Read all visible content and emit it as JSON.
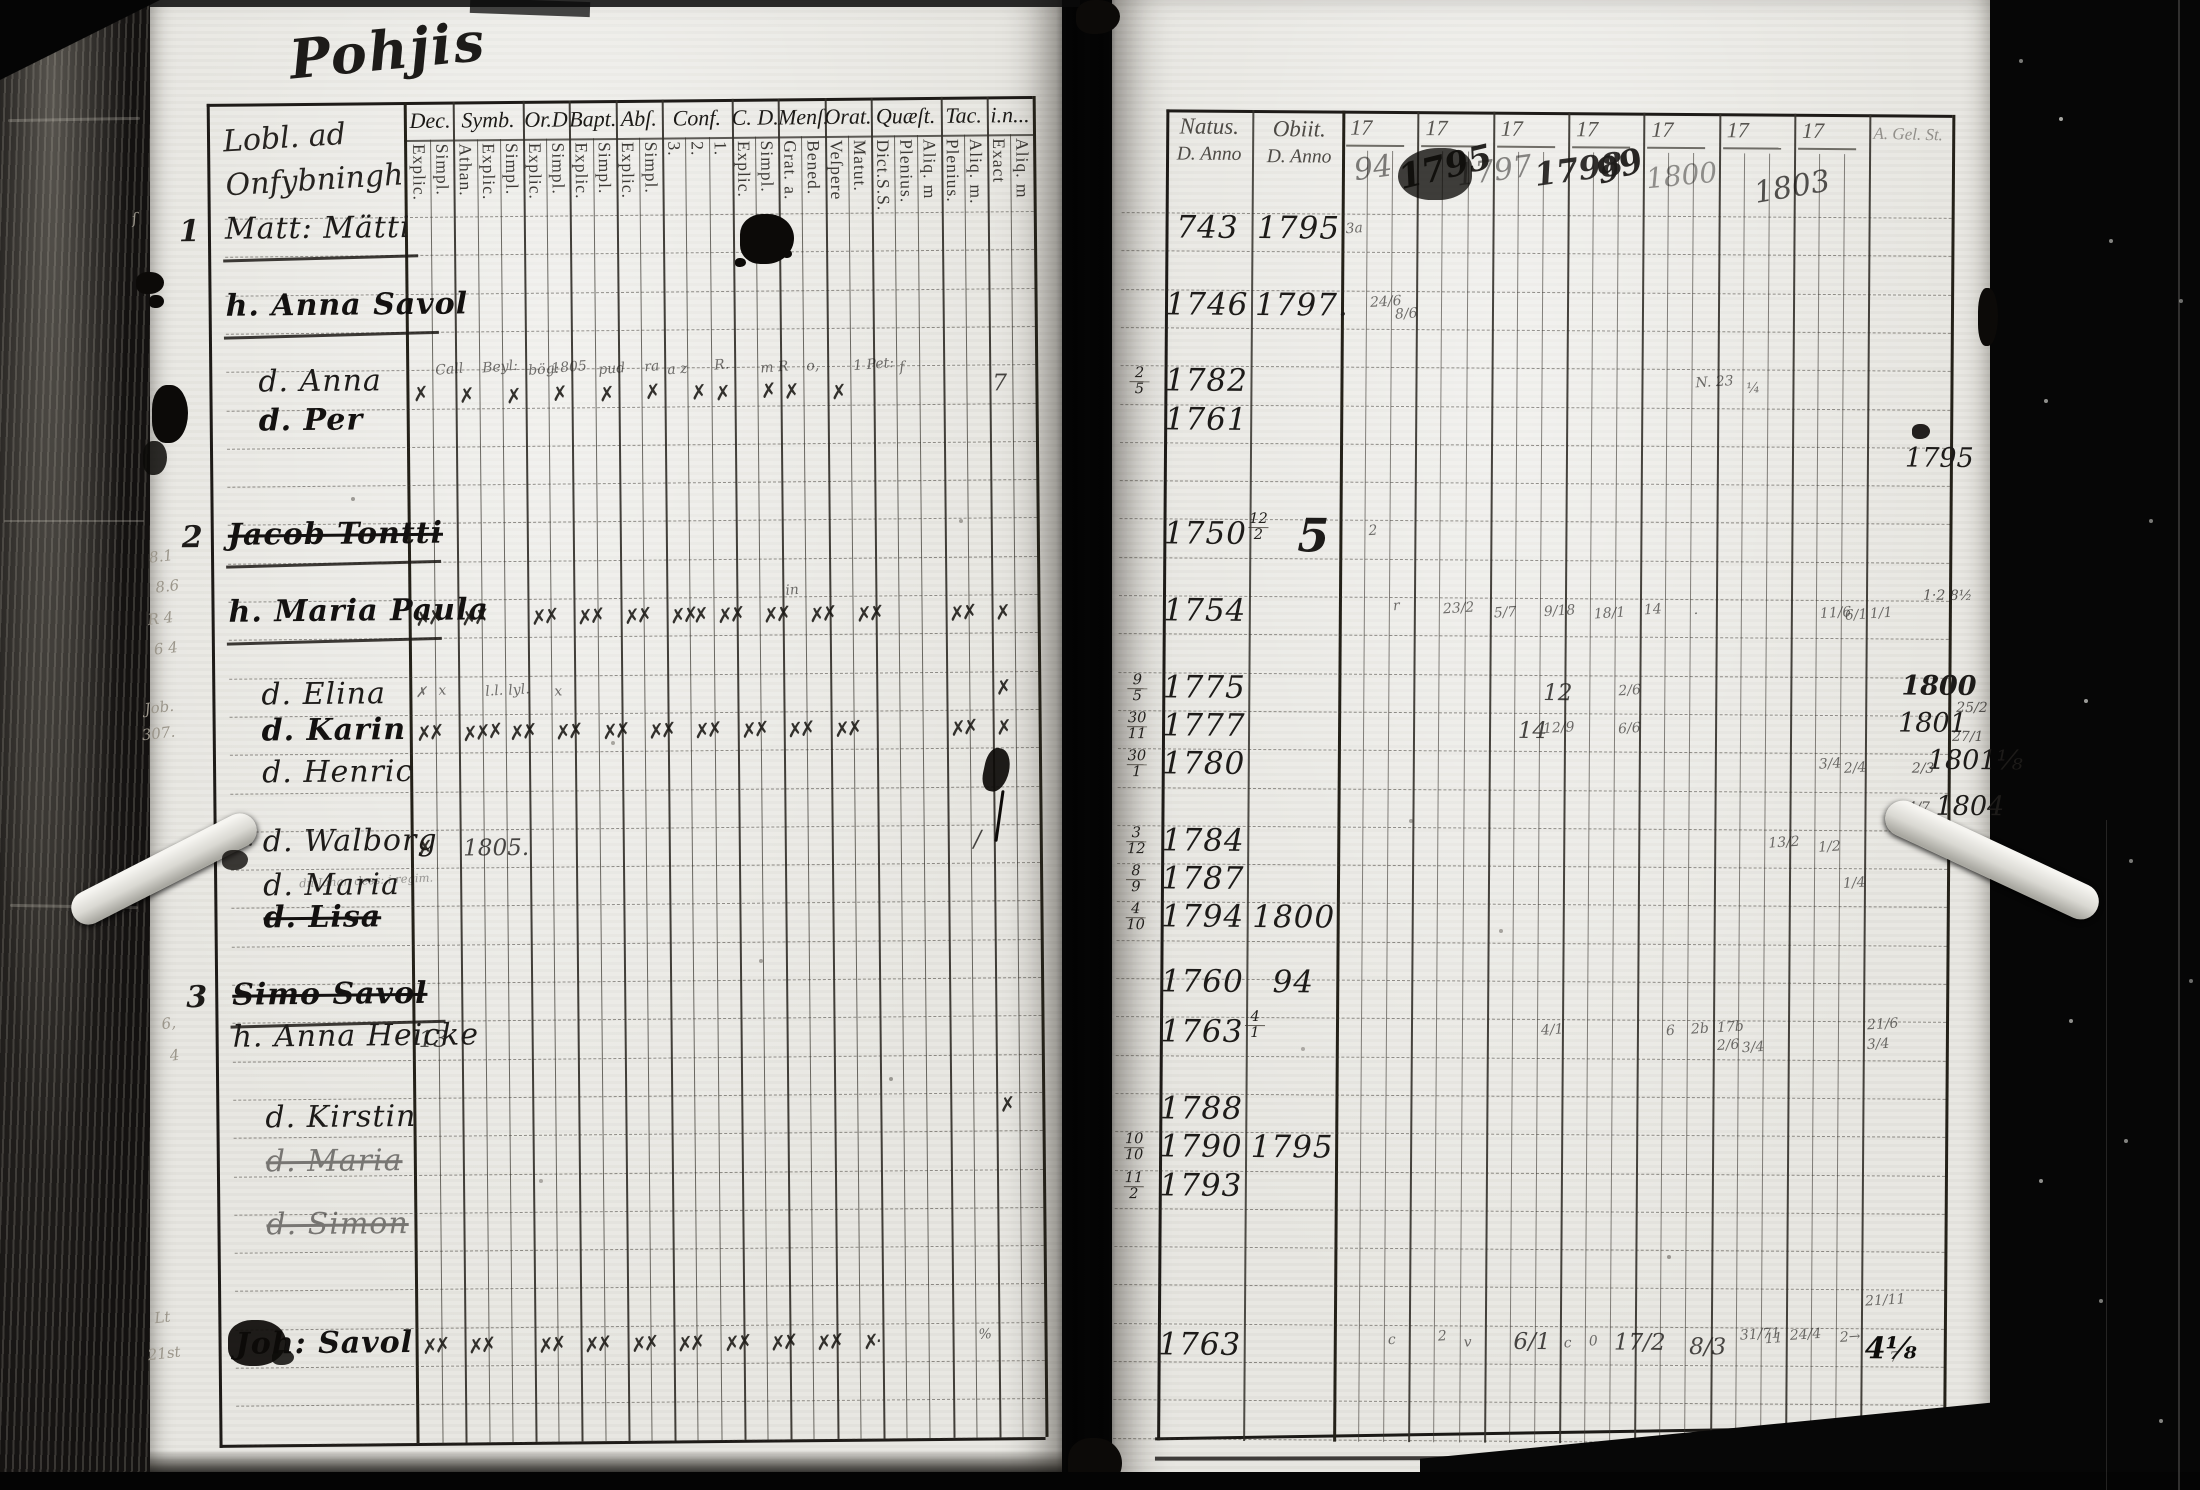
{
  "title": "Pohjis",
  "left_page": {
    "heading_line1": "Lobl. ad",
    "heading_line2": "Onfybningh",
    "columns": [
      {
        "label": "Dec.",
        "subs": [
          "Explic.",
          "Simpl."
        ]
      },
      {
        "label": "Symb.",
        "subs": [
          "Athan.",
          "Explic.",
          "Simpl."
        ]
      },
      {
        "label": "Or.D",
        "subs": [
          "Explic.",
          "Simpl."
        ]
      },
      {
        "label": "Bapt.",
        "subs": [
          "Explic.",
          "Simpl."
        ]
      },
      {
        "label": "Abſ.",
        "subs": [
          "Explic.",
          "Simpl."
        ]
      },
      {
        "label": "Conf.",
        "subs": [
          "3.",
          "2.",
          "1."
        ]
      },
      {
        "label": "C. D.",
        "subs": [
          "Explic.",
          "Simpl."
        ]
      },
      {
        "label": "Menſ.",
        "subs": [
          "Grat. a.",
          "Bened."
        ]
      },
      {
        "label": "Orat.",
        "subs": [
          "Veſpere",
          "Matut."
        ]
      },
      {
        "label": "Quæſt.",
        "subs": [
          "Dict.S.S.",
          "Plenius.",
          "Aliq. m"
        ]
      },
      {
        "label": "Tac.",
        "subs": [
          "Plenius.",
          "Aliq. m."
        ]
      },
      {
        "label": "i.n...",
        "subs": [
          "Exact",
          "Aliq. m"
        ]
      }
    ],
    "row_numbers": [
      {
        "n": "1",
        "r": 0
      },
      {
        "n": "2",
        "r": 8
      },
      {
        "n": "3",
        "r": 20
      }
    ],
    "entries": [
      {
        "r": 0,
        "name": "Matt: Mätti",
        "u": 1
      },
      {
        "r": 2,
        "name": "h. Anna Savol",
        "u": 1,
        "b": 1
      },
      {
        "r": 4,
        "name": "d. Anna",
        "ind": 1
      },
      {
        "r": 5,
        "name": "d. Per",
        "ind": 1,
        "b": 1
      },
      {
        "r": 8,
        "name": "Jacob Tontti",
        "u": 1,
        "b": 1,
        "s": 1
      },
      {
        "r": 10,
        "name": "h. Maria Paula",
        "u": 1,
        "b": 1
      },
      {
        "r": 12,
        "name": "d. Elina",
        "ind": 1,
        "dy": 6
      },
      {
        "r": 13,
        "name": "d. Karin",
        "ind": 1,
        "dy": 4,
        "b": 1
      },
      {
        "r": 14,
        "name": "d. Henric",
        "ind": 1,
        "dy": 8
      },
      {
        "r": 16,
        "name": "d. Walborg",
        "ind": 1,
        "pre": "Jf.",
        "note": "dn Johan dess: i regim."
      },
      {
        "r": 17,
        "name": "d. Maria",
        "ind": 1,
        "dy": 6
      },
      {
        "r": 18,
        "name": "d. Lisa",
        "ind": 1,
        "b": 1,
        "s": 1
      },
      {
        "r": 20,
        "name": "Simo Savol",
        "u": 1,
        "b": 1,
        "s": 1
      },
      {
        "r": 21,
        "name": "h. Anna Heicke",
        "dy": 4
      },
      {
        "r": 23,
        "name": "d. Kirstin",
        "ind": 1,
        "dy": 8
      },
      {
        "r": 24,
        "name": "d. Maria",
        "ind": 1,
        "s": 1,
        "dy": 14,
        "f": 1
      },
      {
        "r": 26,
        "name": "d. Simon",
        "ind": 1,
        "s": 1,
        "f": 1
      },
      {
        "r": 29,
        "name": "Joh: Savol",
        "b": 1,
        "dy": 4
      }
    ],
    "marks": [
      [
        4,
        1,
        "Call",
        "w",
        -14
      ],
      [
        4,
        3,
        "Beyl:",
        "w",
        -16
      ],
      [
        4,
        5,
        "bög:",
        "w",
        -13
      ],
      [
        4,
        6,
        "1805",
        "w",
        -15
      ],
      [
        4,
        8,
        "pud",
        "w",
        -13
      ],
      [
        4,
        10,
        "ra",
        "w",
        -15
      ],
      [
        4,
        11,
        "a z",
        "w",
        -12
      ],
      [
        4,
        13,
        "R.",
        "w",
        -16
      ],
      [
        4,
        15,
        "m R",
        "w",
        -13
      ],
      [
        4,
        17,
        "o,",
        "w",
        -14
      ],
      [
        4,
        19,
        "1 Pet:",
        "w",
        -15
      ],
      [
        4,
        21,
        "f",
        "w",
        -12
      ],
      [
        4,
        0,
        "✗",
        "x",
        6
      ],
      [
        4,
        2,
        "✗",
        "x",
        8
      ],
      [
        4,
        4,
        "✗",
        "x",
        9
      ],
      [
        4,
        6,
        "✗",
        "x",
        7
      ],
      [
        4,
        8,
        "✗",
        "x",
        8
      ],
      [
        4,
        10,
        "✗",
        "x",
        6
      ],
      [
        4,
        12,
        "✗",
        "x",
        7
      ],
      [
        4,
        13,
        "✗",
        "x",
        8
      ],
      [
        4,
        15,
        "✗",
        "x",
        6
      ],
      [
        4,
        16,
        "✗",
        "x",
        7
      ],
      [
        4,
        18,
        "✗",
        "x",
        8
      ],
      [
        4,
        25,
        "7",
        "h",
        0
      ],
      [
        10,
        0,
        "✗✗",
        "x",
        0
      ],
      [
        10,
        2,
        "✗✗",
        "x",
        0
      ],
      [
        10,
        5,
        "✗✗",
        "x",
        0
      ],
      [
        10,
        7,
        "✗✗",
        "x",
        0
      ],
      [
        10,
        9,
        "✗✗",
        "x",
        0
      ],
      [
        10,
        11,
        "✗✗",
        "x",
        0
      ],
      [
        10,
        12,
        "✗",
        "x",
        0
      ],
      [
        10,
        13,
        "✗✗",
        "x",
        0
      ],
      [
        10,
        15,
        "✗✗",
        "x",
        0
      ],
      [
        10,
        17,
        "✗✗",
        "x",
        0
      ],
      [
        10,
        19,
        "✗✗",
        "x",
        0
      ],
      [
        10,
        23,
        "✗✗",
        "x",
        0
      ],
      [
        10,
        25,
        "✗",
        "x",
        0
      ],
      [
        10,
        16,
        "in",
        "w",
        -20
      ],
      [
        12,
        0,
        "✗",
        "w",
        2
      ],
      [
        12,
        1,
        "x",
        "w",
        0
      ],
      [
        12,
        3,
        "l.l.",
        "w",
        1
      ],
      [
        12,
        4,
        "lyl.",
        "w",
        0
      ],
      [
        12,
        6,
        "x",
        "w",
        2
      ],
      [
        12,
        25,
        "✗",
        "x",
        -2
      ],
      [
        13,
        0,
        "✗✗",
        "x",
        0
      ],
      [
        13,
        2,
        "✗✗✗",
        "x",
        0
      ],
      [
        13,
        4,
        "✗✗",
        "x",
        0
      ],
      [
        13,
        6,
        "✗✗",
        "x",
        0
      ],
      [
        13,
        8,
        "✗✗",
        "x",
        0
      ],
      [
        13,
        10,
        "✗✗",
        "x",
        0
      ],
      [
        13,
        12,
        "✗✗",
        "x",
        0
      ],
      [
        13,
        14,
        "✗✗",
        "x",
        0
      ],
      [
        13,
        16,
        "✗✗",
        "x",
        0
      ],
      [
        13,
        18,
        "✗✗",
        "x",
        0
      ],
      [
        13,
        23,
        "✗✗",
        "x",
        0
      ],
      [
        13,
        25,
        "✗",
        "x",
        0
      ],
      [
        16,
        0,
        "✗",
        "x",
        0
      ],
      [
        16,
        2,
        "1805.",
        "h",
        0
      ],
      [
        16,
        24,
        "∕",
        "h",
        -4
      ],
      [
        21,
        0,
        "13",
        "h",
        0
      ],
      [
        23,
        25,
        "✗",
        "x",
        -6
      ],
      [
        29,
        0,
        "✗✗",
        "x",
        0
      ],
      [
        29,
        2,
        "✗✗",
        "x",
        0
      ],
      [
        29,
        5,
        "✗✗",
        "x",
        0
      ],
      [
        29,
        7,
        "✗✗",
        "x",
        0
      ],
      [
        29,
        9,
        "✗✗",
        "x",
        0
      ],
      [
        29,
        11,
        "✗✗",
        "x",
        0
      ],
      [
        29,
        13,
        "✗✗",
        "x",
        0
      ],
      [
        29,
        15,
        "✗✗",
        "x",
        0
      ],
      [
        29,
        17,
        "✗✗",
        "x",
        0
      ],
      [
        29,
        19,
        "✗·",
        "x",
        0
      ],
      [
        29,
        24,
        "%",
        "w",
        -2
      ]
    ],
    "margin_notes": [
      {
        "t": "ſ",
        "x": 137,
        "y": 205
      },
      {
        "t": "8.1",
        "x": 151,
        "y": 543
      },
      {
        "t": "8.6",
        "x": 157,
        "y": 573
      },
      {
        "t": "R 4",
        "x": 149,
        "y": 605
      },
      {
        "t": "6 4",
        "x": 155,
        "y": 635
      },
      {
        "t": "Job.",
        "x": 145,
        "y": 694
      },
      {
        "t": "307.",
        "x": 142,
        "y": 720
      },
      {
        "t": "6,",
        "x": 159,
        "y": 1010
      },
      {
        "t": "4",
        "x": 167,
        "y": 1042
      },
      {
        "t": "Lt",
        "x": 149,
        "y": 1304
      },
      {
        "t": "21st",
        "x": 142,
        "y": 1340
      }
    ]
  },
  "right_page": {
    "natus_label": "Natus.",
    "natus_sub": "D. Anno",
    "obiit_label": "Obiit.",
    "obiit_sub": "D. Anno",
    "year_prefix": "17",
    "written_years": [
      "94",
      "1795",
      "1797",
      "1798",
      "99",
      "1800",
      "1803"
    ],
    "end_label": "A. Gel. St.",
    "entries": [
      {
        "r": 0,
        "natus": "743",
        "obiit": "1795"
      },
      {
        "r": 2,
        "natus": "1746",
        "obiit": "1797."
      },
      {
        "r": 4,
        "day": "2|5",
        "natus": "1782"
      },
      {
        "r": 5,
        "natus": "1761"
      },
      {
        "r": 8,
        "natus": "1750",
        "obiit": "5",
        "big": 1,
        "osmall": "12|2"
      },
      {
        "r": 10,
        "natus": "1754"
      },
      {
        "r": 12,
        "day": "9|5",
        "natus": "1775"
      },
      {
        "r": 13,
        "day": "30|11",
        "natus": "1777"
      },
      {
        "r": 14,
        "day": "30|1",
        "natus": "1780"
      },
      {
        "r": 16,
        "day": "3|12",
        "natus": "1784"
      },
      {
        "r": 17,
        "day": "8|9",
        "natus": "1787"
      },
      {
        "r": 18,
        "day": "4|10",
        "natus": "1794",
        "obiit": "1800"
      },
      {
        "r": 20,
        "natus": "1760",
        "obiit": "94",
        "dy": -12
      },
      {
        "r": 21,
        "natus": "1763",
        "osmall": "4|1"
      },
      {
        "r": 23,
        "natus": "1788"
      },
      {
        "r": 24,
        "day": "10|10",
        "natus": "1790",
        "obiit": "1795"
      },
      {
        "r": 25,
        "day": "11|2",
        "natus": "1793"
      },
      {
        "r": 29,
        "natus": "1763",
        "dy": 6
      }
    ],
    "marks": [
      [
        0,
        0,
        "3a",
        "w",
        0
      ],
      [
        2,
        1,
        "24/6",
        "w",
        -4
      ],
      [
        2,
        2,
        "8/6",
        "w",
        8
      ],
      [
        4,
        14,
        "N. 23",
        "w",
        -2
      ],
      [
        4,
        16,
        "¼",
        "w",
        4
      ],
      [
        8,
        1,
        "2",
        "w",
        -4
      ],
      [
        10,
        2,
        "r",
        "w",
        -6
      ],
      [
        10,
        4,
        "23/2",
        "w",
        -4
      ],
      [
        10,
        6,
        "5/7",
        "w",
        0
      ],
      [
        10,
        8,
        "9/18",
        "w",
        -2
      ],
      [
        10,
        10,
        "18/1",
        "w",
        0
      ],
      [
        10,
        12,
        "14",
        "w",
        -4
      ],
      [
        10,
        14,
        "·",
        "w",
        0
      ],
      [
        10,
        19,
        "11/6",
        "w",
        -2
      ],
      [
        10,
        20,
        "6/1",
        "w",
        0
      ],
      [
        10,
        21,
        "1/1",
        "w",
        -2
      ],
      [
        12,
        8,
        "12",
        "h",
        -2
      ],
      [
        12,
        11,
        "2/6",
        "w",
        0
      ],
      [
        13,
        7,
        "14",
        "h",
        -2
      ],
      [
        13,
        8,
        "12/9",
        "w",
        0
      ],
      [
        13,
        11,
        "6/6",
        "w",
        0
      ],
      [
        14,
        19,
        "3/4",
        "w",
        -4
      ],
      [
        14,
        20,
        "2/4",
        "w",
        0
      ],
      [
        16,
        17,
        "13/2",
        "w",
        -2
      ],
      [
        16,
        19,
        "1/2",
        "w",
        2
      ],
      [
        17,
        20,
        "1/4",
        "w",
        0
      ],
      [
        21,
        8,
        "4/1",
        "w",
        -4
      ],
      [
        21,
        13,
        "6",
        "w",
        -4
      ],
      [
        21,
        14,
        "2b",
        "w",
        -6
      ],
      [
        21,
        15,
        "17b",
        "w",
        -8
      ],
      [
        21,
        15,
        "2/6",
        "w",
        10
      ],
      [
        21,
        16,
        "3/4",
        "w",
        12
      ],
      [
        21,
        21,
        "21/6",
        "w",
        -12
      ],
      [
        21,
        21,
        "3/4",
        "w",
        8
      ],
      [
        28,
        21,
        "21/11",
        "w",
        -4
      ],
      [
        29,
        2,
        "c",
        "w",
        0
      ],
      [
        29,
        4,
        "2",
        "w",
        -4
      ],
      [
        29,
        5,
        "v",
        "w",
        2
      ],
      [
        29,
        7,
        "6/1",
        "h",
        -4
      ],
      [
        29,
        9,
        "c",
        "w",
        2
      ],
      [
        29,
        10,
        "0",
        "w",
        0
      ],
      [
        29,
        11,
        "17/2",
        "h",
        -4
      ],
      [
        29,
        14,
        "8/3",
        "h",
        0
      ],
      [
        29,
        16,
        "31/71",
        "w",
        -8
      ],
      [
        29,
        17,
        "11",
        "w",
        -4
      ],
      [
        29,
        18,
        "24/4",
        "w",
        -8
      ],
      [
        29,
        20,
        "2→",
        "w",
        -6
      ],
      [
        29,
        21,
        "4⅛",
        "X",
        -4
      ],
      [
        29,
        22,
        "7",
        "w",
        14
      ]
    ],
    "margin_years": [
      {
        "t": "1795",
        "x": 1903,
        "y": 440,
        "c": "my"
      },
      {
        "t": "1·2 8½",
        "x": 1922,
        "y": 585,
        "c": "mys"
      },
      {
        "t": "1800",
        "x": 1901,
        "y": 668,
        "c": "my b2"
      },
      {
        "t": "1801",
        "x": 1898,
        "y": 705,
        "c": "my"
      },
      {
        "t": "25/2",
        "x": 1956,
        "y": 697,
        "c": "mys"
      },
      {
        "t": "27/1",
        "x": 1952,
        "y": 726,
        "c": "mys"
      },
      {
        "t": "1801⅛",
        "x": 1928,
        "y": 742,
        "c": "my"
      },
      {
        "t": "2/3",
        "x": 1912,
        "y": 758,
        "c": "mys"
      },
      {
        "t": "1804",
        "x": 1936,
        "y": 788,
        "c": "my"
      },
      {
        "t": "44/7",
        "x": 1899,
        "y": 797,
        "c": "mys"
      }
    ]
  }
}
